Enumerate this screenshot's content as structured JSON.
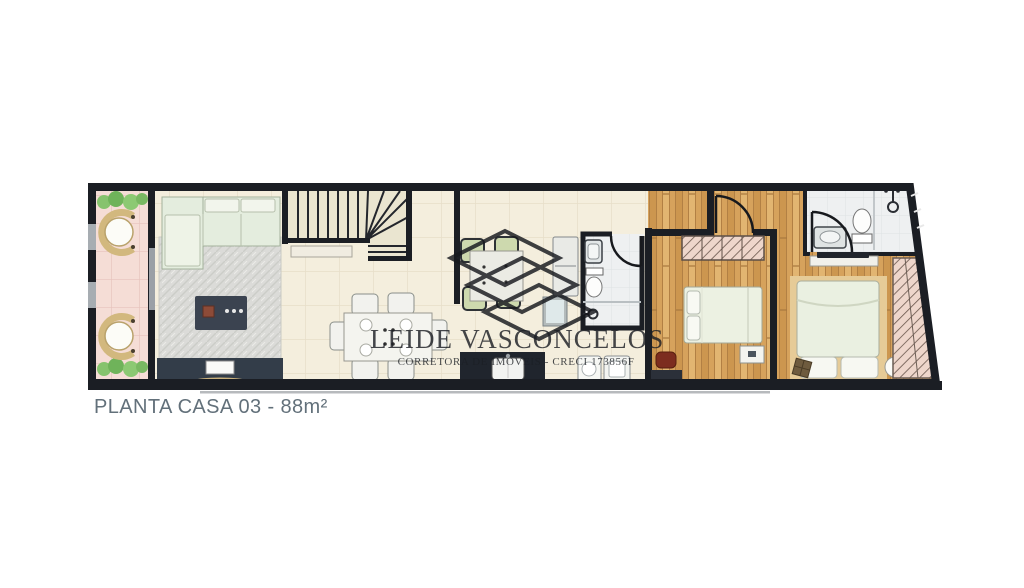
{
  "caption": "PLANTA CASA 03 - 88m²",
  "watermark": {
    "line1": "LEIDE VASCONCELOS",
    "line2": "CORRETORA DE IMÓVEIS - CRECI 173856F"
  },
  "colors": {
    "background": "#ffffff",
    "walls": "#1b1e24",
    "floor_social": "#f4eedd",
    "floor_wood": "#d6a25c",
    "floor_patio": "#f5ddd6",
    "bath_tile": "#eef0f1",
    "rug": "#dbdbd8",
    "sofa": "#e4edde",
    "dark_furniture": "#333d49",
    "plant_green": "#6fb35a",
    "bench_tan": "#d2b87e",
    "stool_red": "#7c2d1f",
    "caption_text": "#62707a",
    "window_glass": "#a7adb2"
  }
}
